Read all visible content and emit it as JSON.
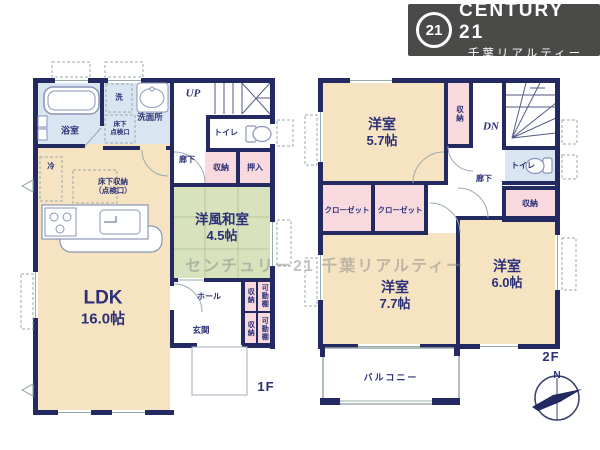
{
  "logo": {
    "badge": "21",
    "brand": "CENTURY 21",
    "subtitle": "千葉リアルティー"
  },
  "watermark": "センチュリー21 千葉リアルティー",
  "colors": {
    "wall": "#232a62",
    "room_cream": "#f6e3c1",
    "room_tatami": "#d8e3bd",
    "room_pink": "#f7d9de",
    "room_blue": "#d9e5f1",
    "logo_bg": "#4a4a48"
  },
  "floor1": {
    "floor_label": "1F",
    "stairs": "UP",
    "bath": "浴室",
    "washer": "洗",
    "washroom": "洗面所",
    "underfloor_hatch_l1": "床下",
    "underfloor_hatch_l2": "点検口",
    "fridge": "冷",
    "underfloor_storage_l1": "床下収納",
    "underfloor_storage_l2": "（点検口）",
    "ldk": "LDK",
    "ldk_size": "16.0帖",
    "toilet": "トイレ",
    "hallway": "廊下",
    "storage": "収納",
    "oshiire": "押入",
    "tatami_room": "洋風和室",
    "tatami_room_size": "4.5帖",
    "hall": "ホール",
    "entrance": "玄関",
    "storage_a": "収納",
    "shelf_a": "可動棚",
    "storage_b": "収納",
    "shelf_b": "可動棚"
  },
  "floor2": {
    "floor_label": "2F",
    "stairs": "DN",
    "room_a": "洋室",
    "room_a_size": "5.7帖",
    "storage_top": "収納",
    "toilet": "トイレ",
    "hallway": "廊下",
    "storage_right": "収納",
    "closet_a": "クローゼット",
    "closet_b": "クローゼット",
    "room_b": "洋室",
    "room_b_size": "7.7帖",
    "room_c": "洋室",
    "room_c_size": "6.0帖",
    "balcony": "バルコニー",
    "compass_north": "N"
  }
}
